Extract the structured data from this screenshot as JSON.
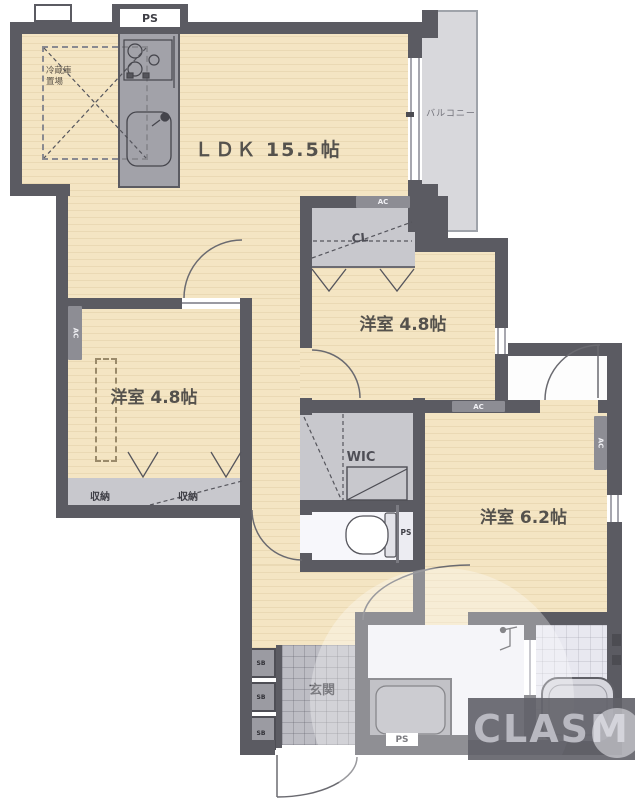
{
  "floorplan": {
    "watermark": "CLASM",
    "labels": {
      "ldk": "ＬＤＫ 15.5帖",
      "bedroom_right": "洋室 4.8帖",
      "bedroom_left": "洋室 4.8帖",
      "bedroom_main": "洋室 6.2帖",
      "wic": "WIC",
      "cl": "CL",
      "genkan": "玄関",
      "balcony": "バルコニー",
      "closet_left": "収納",
      "closet_right": "収納",
      "ps": "PS",
      "ac": "AC",
      "sb": "SB",
      "fridge_space_line1": "冷蔵庫",
      "fridge_space_line2": "置場"
    },
    "room_sizes": {
      "ldk_jo": 15.5,
      "bedroom_right_jo": 4.8,
      "bedroom_left_jo": 4.8,
      "bedroom_main_jo": 6.2
    },
    "colors": {
      "wall": "#5b5b62",
      "wood_floor": "#f4e5c3",
      "closet": "#c8c8cd",
      "tile": "#bdbdc4",
      "wet_area": "#f1f1f6",
      "balcony": "#d8d8dc",
      "watermark_bg": "#60606a"
    }
  }
}
